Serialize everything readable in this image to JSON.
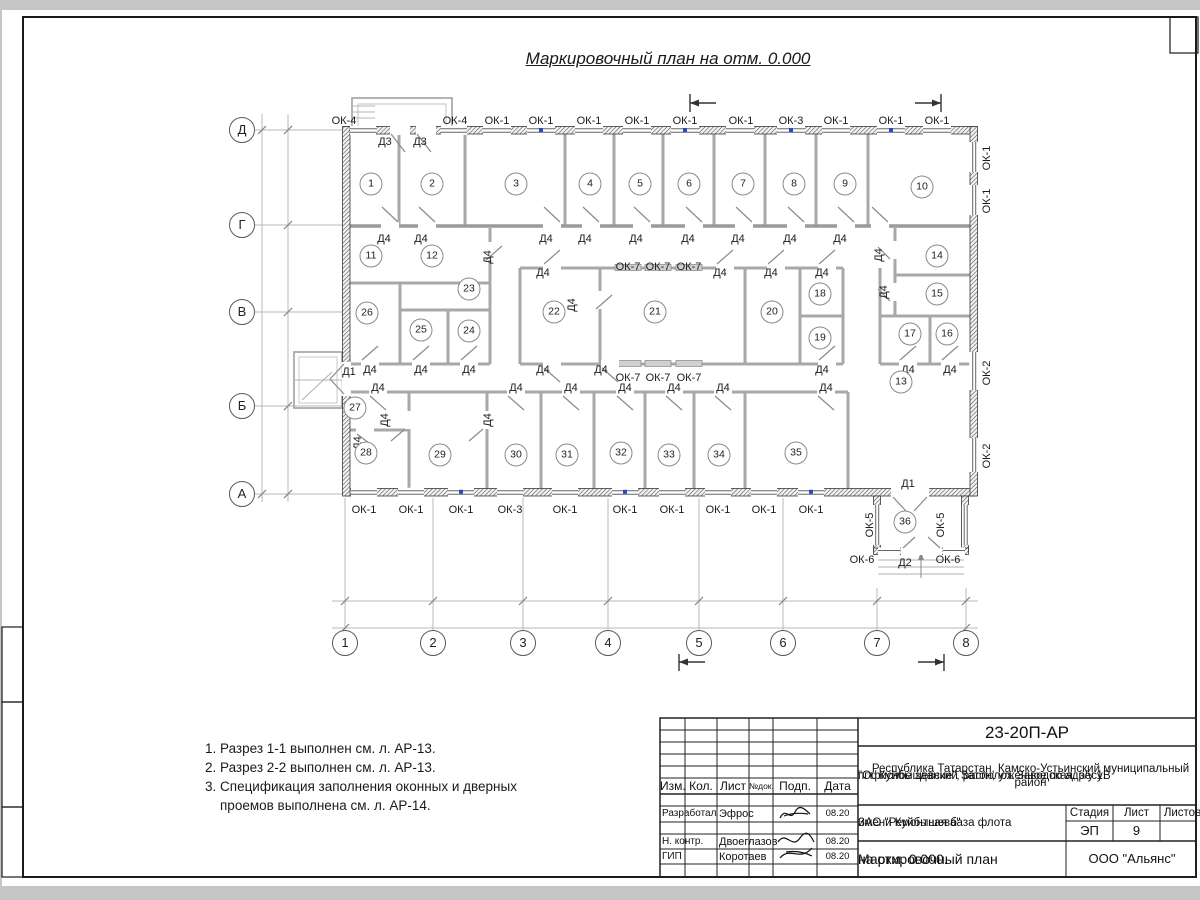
{
  "sheet": {
    "title": "Маркировочный план на отм. 0.000",
    "notes": [
      "1. Разрез 1-1 выполнен см. л. АР-13.",
      "2. Разрез 2-2 выполнен см. л. АР-13.",
      "3. Спецификация заполнения оконных и дверных",
      "проемов выполнена см. л. АР-14."
    ]
  },
  "plan": {
    "rooms": [
      {
        "n": "1",
        "x": 371,
        "y": 184
      },
      {
        "n": "2",
        "x": 432,
        "y": 184
      },
      {
        "n": "3",
        "x": 516,
        "y": 184
      },
      {
        "n": "4",
        "x": 590,
        "y": 184
      },
      {
        "n": "5",
        "x": 640,
        "y": 184
      },
      {
        "n": "6",
        "x": 689,
        "y": 184
      },
      {
        "n": "7",
        "x": 743,
        "y": 184
      },
      {
        "n": "8",
        "x": 794,
        "y": 184
      },
      {
        "n": "9",
        "x": 845,
        "y": 184
      },
      {
        "n": "10",
        "x": 922,
        "y": 187
      },
      {
        "n": "11",
        "x": 371,
        "y": 256
      },
      {
        "n": "12",
        "x": 432,
        "y": 256
      },
      {
        "n": "23",
        "x": 469,
        "y": 289
      },
      {
        "n": "26",
        "x": 367,
        "y": 313
      },
      {
        "n": "25",
        "x": 421,
        "y": 330
      },
      {
        "n": "24",
        "x": 469,
        "y": 331
      },
      {
        "n": "22",
        "x": 554,
        "y": 312
      },
      {
        "n": "21",
        "x": 655,
        "y": 312
      },
      {
        "n": "20",
        "x": 772,
        "y": 312
      },
      {
        "n": "18",
        "x": 820,
        "y": 294
      },
      {
        "n": "19",
        "x": 820,
        "y": 338
      },
      {
        "n": "14",
        "x": 937,
        "y": 256
      },
      {
        "n": "15",
        "x": 937,
        "y": 294
      },
      {
        "n": "17",
        "x": 910,
        "y": 334
      },
      {
        "n": "16",
        "x": 947,
        "y": 334
      },
      {
        "n": "13",
        "x": 901,
        "y": 382
      },
      {
        "n": "27",
        "x": 355,
        "y": 408
      },
      {
        "n": "28",
        "x": 366,
        "y": 453
      },
      {
        "n": "29",
        "x": 440,
        "y": 455
      },
      {
        "n": "30",
        "x": 516,
        "y": 455
      },
      {
        "n": "31",
        "x": 567,
        "y": 455
      },
      {
        "n": "32",
        "x": 621,
        "y": 453
      },
      {
        "n": "33",
        "x": 669,
        "y": 455
      },
      {
        "n": "34",
        "x": 719,
        "y": 455
      },
      {
        "n": "35",
        "x": 796,
        "y": 453
      },
      {
        "n": "36",
        "x": 905,
        "y": 522
      }
    ],
    "marks": [
      {
        "t": "ОК-4",
        "x": 344,
        "y": 121
      },
      {
        "t": "ОК-4",
        "x": 455,
        "y": 121
      },
      {
        "t": "ОК-1",
        "x": 497,
        "y": 121
      },
      {
        "t": "ОК-1",
        "x": 541,
        "y": 121
      },
      {
        "t": "ОК-1",
        "x": 589,
        "y": 121
      },
      {
        "t": "ОК-1",
        "x": 637,
        "y": 121
      },
      {
        "t": "ОК-1",
        "x": 685,
        "y": 121
      },
      {
        "t": "ОК-1",
        "x": 741,
        "y": 121
      },
      {
        "t": "ОК-3",
        "x": 791,
        "y": 121
      },
      {
        "t": "ОК-1",
        "x": 836,
        "y": 121
      },
      {
        "t": "ОК-1",
        "x": 891,
        "y": 121
      },
      {
        "t": "ОК-1",
        "x": 937,
        "y": 121
      },
      {
        "t": "Д3",
        "x": 385,
        "y": 142
      },
      {
        "t": "Д3",
        "x": 420,
        "y": 142
      },
      {
        "t": "ОК-1",
        "x": 987,
        "y": 158,
        "r": 1
      },
      {
        "t": "ОК-1",
        "x": 987,
        "y": 201,
        "r": 1
      },
      {
        "t": "ОК-2",
        "x": 987,
        "y": 373,
        "r": 1
      },
      {
        "t": "ОК-2",
        "x": 987,
        "y": 456,
        "r": 1
      },
      {
        "t": "ОК-1",
        "x": 364,
        "y": 510
      },
      {
        "t": "ОК-1",
        "x": 411,
        "y": 510
      },
      {
        "t": "ОК-1",
        "x": 461,
        "y": 510
      },
      {
        "t": "ОК-3",
        "x": 510,
        "y": 510
      },
      {
        "t": "ОК-1",
        "x": 565,
        "y": 510
      },
      {
        "t": "ОК-1",
        "x": 625,
        "y": 510
      },
      {
        "t": "ОК-1",
        "x": 672,
        "y": 510
      },
      {
        "t": "ОК-1",
        "x": 718,
        "y": 510
      },
      {
        "t": "ОК-1",
        "x": 764,
        "y": 510
      },
      {
        "t": "ОК-1",
        "x": 811,
        "y": 510
      },
      {
        "t": "ОК-5",
        "x": 870,
        "y": 525,
        "r": 1
      },
      {
        "t": "ОК-5",
        "x": 941,
        "y": 525,
        "r": 1
      },
      {
        "t": "ОК-6",
        "x": 862,
        "y": 560
      },
      {
        "t": "ОК-6",
        "x": 948,
        "y": 560
      },
      {
        "t": "Д2",
        "x": 905,
        "y": 563
      },
      {
        "t": "Д1",
        "x": 908,
        "y": 484
      },
      {
        "t": "Д1",
        "x": 349,
        "y": 372
      },
      {
        "t": "Д4",
        "x": 384,
        "y": 239
      },
      {
        "t": "Д4",
        "x": 421,
        "y": 239
      },
      {
        "t": "Д4",
        "x": 546,
        "y": 239
      },
      {
        "t": "Д4",
        "x": 585,
        "y": 239
      },
      {
        "t": "Д4",
        "x": 636,
        "y": 239
      },
      {
        "t": "Д4",
        "x": 688,
        "y": 239
      },
      {
        "t": "Д4",
        "x": 738,
        "y": 239
      },
      {
        "t": "Д4",
        "x": 790,
        "y": 239
      },
      {
        "t": "Д4",
        "x": 840,
        "y": 239
      },
      {
        "t": "Д4",
        "x": 543,
        "y": 273
      },
      {
        "t": "Д4",
        "x": 720,
        "y": 273
      },
      {
        "t": "Д4",
        "x": 771,
        "y": 273
      },
      {
        "t": "Д4",
        "x": 822,
        "y": 273
      },
      {
        "t": "Д4",
        "x": 370,
        "y": 370
      },
      {
        "t": "Д4",
        "x": 421,
        "y": 370
      },
      {
        "t": "Д4",
        "x": 469,
        "y": 370
      },
      {
        "t": "Д4",
        "x": 543,
        "y": 370
      },
      {
        "t": "Д4",
        "x": 601,
        "y": 370
      },
      {
        "t": "Д4",
        "x": 822,
        "y": 370
      },
      {
        "t": "Д4",
        "x": 908,
        "y": 370
      },
      {
        "t": "Д4",
        "x": 950,
        "y": 370
      },
      {
        "t": "Д4",
        "x": 378,
        "y": 388
      },
      {
        "t": "Д4",
        "x": 516,
        "y": 388
      },
      {
        "t": "Д4",
        "x": 571,
        "y": 388
      },
      {
        "t": "Д4",
        "x": 625,
        "y": 388
      },
      {
        "t": "Д4",
        "x": 674,
        "y": 388
      },
      {
        "t": "Д4",
        "x": 723,
        "y": 388
      },
      {
        "t": "Д4",
        "x": 826,
        "y": 388
      },
      {
        "t": "Д4",
        "x": 488,
        "y": 257,
        "r": 1
      },
      {
        "t": "Д4",
        "x": 879,
        "y": 255,
        "r": 1
      },
      {
        "t": "Д4",
        "x": 572,
        "y": 305,
        "r": 1
      },
      {
        "t": "Д4",
        "x": 884,
        "y": 292,
        "r": 1
      },
      {
        "t": "Д4",
        "x": 385,
        "y": 420,
        "r": 1
      },
      {
        "t": "Д4",
        "x": 488,
        "y": 420,
        "r": 1
      },
      {
        "t": "Д4",
        "x": 358,
        "y": 443,
        "r": 1
      },
      {
        "t": "ОК-7",
        "x": 628,
        "y": 267
      },
      {
        "t": "ОК-7",
        "x": 658,
        "y": 267
      },
      {
        "t": "ОК-7",
        "x": 689,
        "y": 267
      },
      {
        "t": "ОК-7",
        "x": 628,
        "y": 378
      },
      {
        "t": "ОК-7",
        "x": 658,
        "y": 378
      },
      {
        "t": "ОК-7",
        "x": 689,
        "y": 378
      }
    ],
    "axes_left": [
      {
        "t": "Д",
        "y": 130
      },
      {
        "t": "Г",
        "y": 225
      },
      {
        "t": "В",
        "y": 312
      },
      {
        "t": "Б",
        "y": 406
      },
      {
        "t": "А",
        "y": 494
      }
    ],
    "axes_bottom": [
      {
        "t": "1",
        "x": 345
      },
      {
        "t": "2",
        "x": 433
      },
      {
        "t": "3",
        "x": 523
      },
      {
        "t": "4",
        "x": 608
      },
      {
        "t": "5",
        "x": 699
      },
      {
        "t": "6",
        "x": 783
      },
      {
        "t": "7",
        "x": 877
      },
      {
        "t": "8",
        "x": 966
      }
    ],
    "dims_bottom": [
      {
        "t": "4500",
        "x": 389
      },
      {
        "t": "4500",
        "x": 478
      },
      {
        "t": "4300",
        "x": 565
      },
      {
        "t": "4500",
        "x": 653
      },
      {
        "t": "4200",
        "x": 741
      },
      {
        "t": "4500",
        "x": 830
      },
      {
        "t": "4500",
        "x": 921
      }
    ],
    "dims_left": [
      {
        "t": "4500",
        "y": 177
      },
      {
        "t": "4500",
        "y": 268
      },
      {
        "t": "4500",
        "y": 358
      },
      {
        "t": "4500",
        "y": 450
      }
    ],
    "total_bottom": {
      "t": "31000",
      "x": 655,
      "y": 621
    },
    "total_left": {
      "t": "18000",
      "y": 312,
      "x": 257
    },
    "sections": [
      {
        "t": "1",
        "x": 701,
        "y": 88
      },
      {
        "t": "2",
        "x": 931,
        "y": 88
      },
      {
        "t": "1",
        "x": 691,
        "y": 677
      },
      {
        "t": "2",
        "x": 937,
        "y": 677
      }
    ],
    "elevation": {
      "t": "0.000",
      "x": 901,
      "y": 412
    },
    "floor_tag": {
      "t": "7",
      "x": 902,
      "y": 437
    }
  },
  "titleblock": {
    "doc_code": "23-20П-АР",
    "address_lines": [
      "\"Офисное здание\", расположенное по адресу:",
      "Республика Татарстан, Камско-Устьинский муниципальный район",
      "пгт. Куйбышевский Затон, ул. Заводская, з/у 1В"
    ],
    "client_lines": [
      "ЗАО \"Ремонтная база флота",
      "имени Куйбышева\""
    ],
    "sheet_name_lines": [
      "Маркировочный план",
      "на отм. 0.000."
    ],
    "org": "ООО \"Альянс\"",
    "cols": {
      "izm": "Изм.",
      "kol": "Кол.",
      "list": "Лист",
      "ndok": "№док.",
      "podp": "Подп.",
      "data": "Дата"
    },
    "stage_label": "Стадия",
    "sheet_label": "Лист",
    "sheets_label": "Листов",
    "stage": "ЭП",
    "sheet_no": "9",
    "rows": [
      {
        "role": "Разработал",
        "name": "Эфрос",
        "date": "08.20"
      },
      {
        "role": "Н. контр.",
        "name": "Двоеглазов",
        "date": "08.20"
      },
      {
        "role": "ГИП",
        "name": "Коротаев",
        "date": "08.20"
      }
    ]
  }
}
